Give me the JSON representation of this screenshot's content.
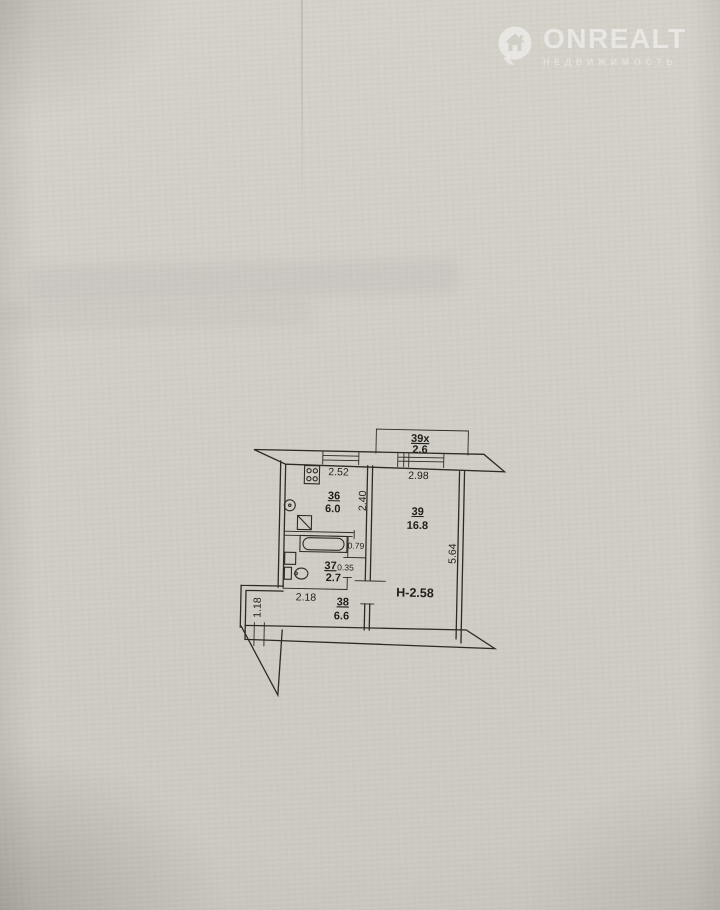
{
  "watermark": {
    "brand": "ONREALT",
    "subtitle": "НЕДВИЖИМОСТЬ"
  },
  "plan": {
    "rooms": {
      "r36": {
        "number": "36",
        "area": "6.0"
      },
      "r37": {
        "number": "37",
        "area": "2.7"
      },
      "r38": {
        "number": "38",
        "area": "6.6"
      },
      "r39": {
        "number": "39",
        "area": "16.8"
      },
      "r39x": {
        "number": "39x",
        "area": "2.6"
      }
    },
    "dims": {
      "kitchen_top": "2.52",
      "room_top": "2.98",
      "kitchen_side": "2.40",
      "room_side": "5.64",
      "niche": "0.79",
      "stub": "0.35",
      "hall_top": "2.18",
      "hall_left": "1.18"
    },
    "ceiling_height": "Н-2.58"
  },
  "colors": {
    "paper": "#d5d2ca",
    "line": "#2a2921",
    "watermark": "#ffffff"
  }
}
